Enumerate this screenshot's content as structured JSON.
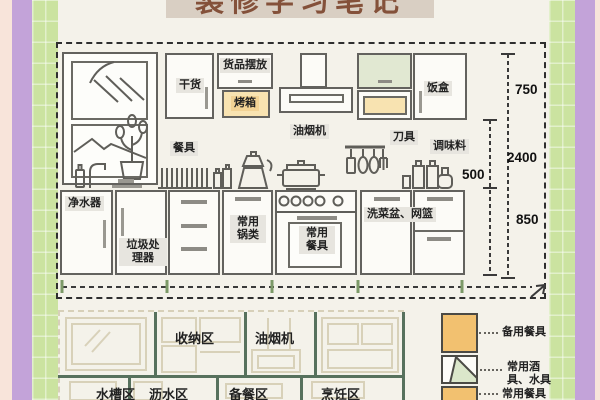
{
  "title": {
    "text": "装修学习笔记"
  },
  "colors": {
    "frame_pink": "#f8e4da",
    "frame_purple": "#c3a3d9",
    "frame_green": "#cbe3a0",
    "paper_cream": "#f4f2ea",
    "highlight_tan": "#f8e3b1",
    "legend_orange": "#f2c170",
    "plan_divider_green": "#57715d",
    "title_brown": "#84513a"
  },
  "elevation": {
    "wall_labels": {
      "dry_goods": "干货",
      "goods_display": "货品摆放",
      "oven": "烤箱",
      "range_hood": "油烟机",
      "lunch_box": "饭盒"
    },
    "counter_labels": {
      "tableware": "餐具",
      "knives": "刀具",
      "seasoning": "调味料"
    },
    "base_labels": {
      "water_purifier": "净水器",
      "garbage_disposal": "垃圾处理器",
      "common_pots": "常用锅类",
      "common_tableware": "常用餐具",
      "sink_basket": "洗菜盆、网篮"
    },
    "dimensions": {
      "upper_height": "750",
      "total_height": "2400",
      "mid_gap": "500",
      "base_height": "850"
    }
  },
  "floor_plan": {
    "zones": {
      "storage": "收纳区",
      "range_hood": "油烟机",
      "sink": "水槽区",
      "drain": "沥水区",
      "prep": "备餐区",
      "cooking": "烹饪区"
    }
  },
  "legend": {
    "spare_tableware": "备用餐具",
    "drinkware": "常用酒具、水具",
    "common_tableware": "常用餐具"
  }
}
